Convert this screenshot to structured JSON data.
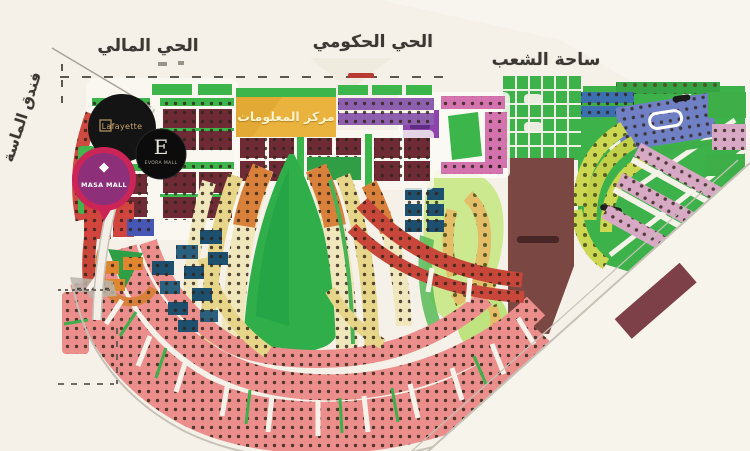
{
  "map": {
    "district_labels": {
      "financial": "الحي المالي",
      "government": "الحي الحكومي",
      "peoples_square": "ساحة الشعب",
      "almasa_hotel": "فندق الماسة"
    },
    "information_center": {
      "label": "مركز المعلومات",
      "banner_color": "#e9b33d",
      "header_color": "#3cb54a"
    },
    "logos": {
      "lafayette": {
        "text": "Lafayette",
        "bg": "#141414",
        "text_color": "#c9a56b"
      },
      "evora": {
        "letter": "E",
        "sub": "EVORA MALL",
        "bg": "#0c0c0c"
      },
      "masa": {
        "text": "MASA MALL",
        "icon": "diamond-icon",
        "ring_color": "#cb2457",
        "fill_color": "#8e2f7a"
      }
    },
    "zone_colors": {
      "central_park_green": "#2fae4a",
      "gridded_square_green": "#3eb24a",
      "ministries_brown": "#7b4742",
      "residential_pink": "#ec8e8c",
      "government_maroon": "#6e2a35",
      "information_banner_yellow": "#e9b33d"
    }
  }
}
